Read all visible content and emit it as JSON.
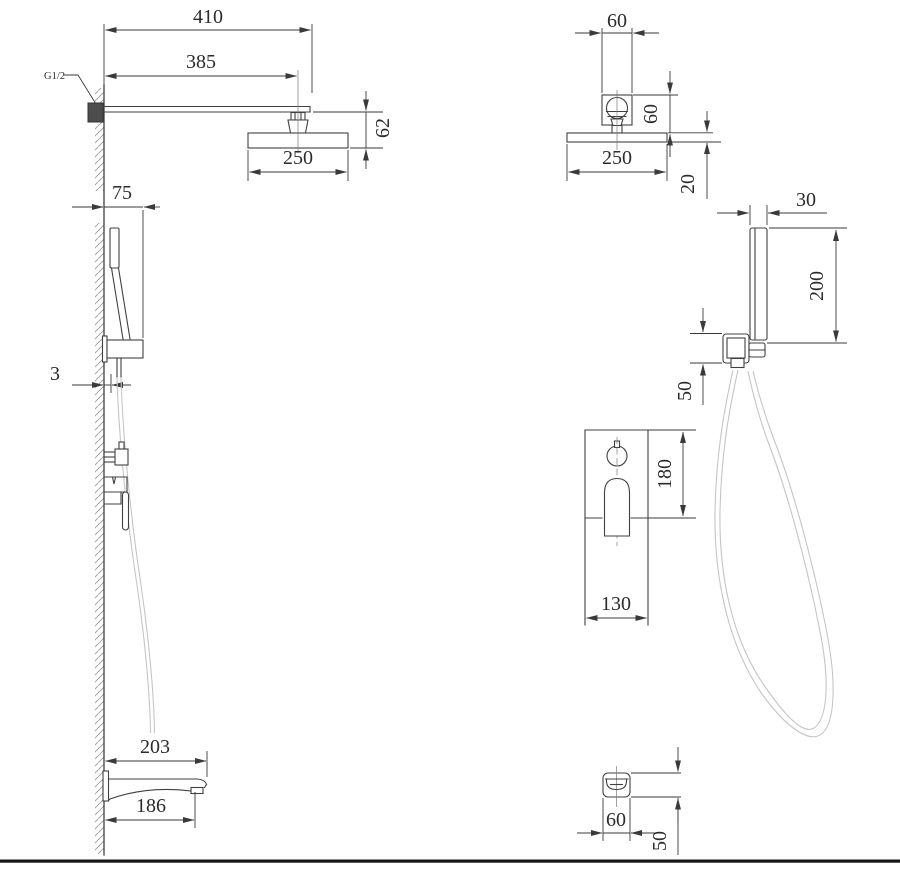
{
  "colors": {
    "background": "#ffffff",
    "line": "#404040",
    "dimension": "#3a3a3a",
    "text": "#2b2b2b",
    "hose": "#c5c5c5",
    "hatch": "#9b9b9b",
    "footer_bar": "#161616"
  },
  "views": {
    "shower_arm_side": {
      "thread": "G1/2",
      "dims": {
        "overall_length": "410",
        "wall_to_head_center": "385",
        "head_drop": "62",
        "head_width": "250"
      }
    },
    "shower_head_front": {
      "dims": {
        "connector_width": "60",
        "connector_height": "60",
        "head_width": "250",
        "head_thickness": "20"
      }
    },
    "hand_shower_side": {
      "dims": {
        "holder_depth": "75",
        "wall_offset": "3"
      }
    },
    "hand_shower_front": {
      "dims": {
        "handle_width": "30",
        "handle_length": "200",
        "holder_height": "50"
      }
    },
    "mixer_front": {
      "dims": {
        "plate_height": "180",
        "plate_width": "130"
      }
    },
    "spout_side": {
      "dims": {
        "overall_length": "203",
        "outlet_length": "186"
      }
    },
    "spout_front": {
      "dims": {
        "width": "60",
        "height": "50"
      }
    }
  }
}
